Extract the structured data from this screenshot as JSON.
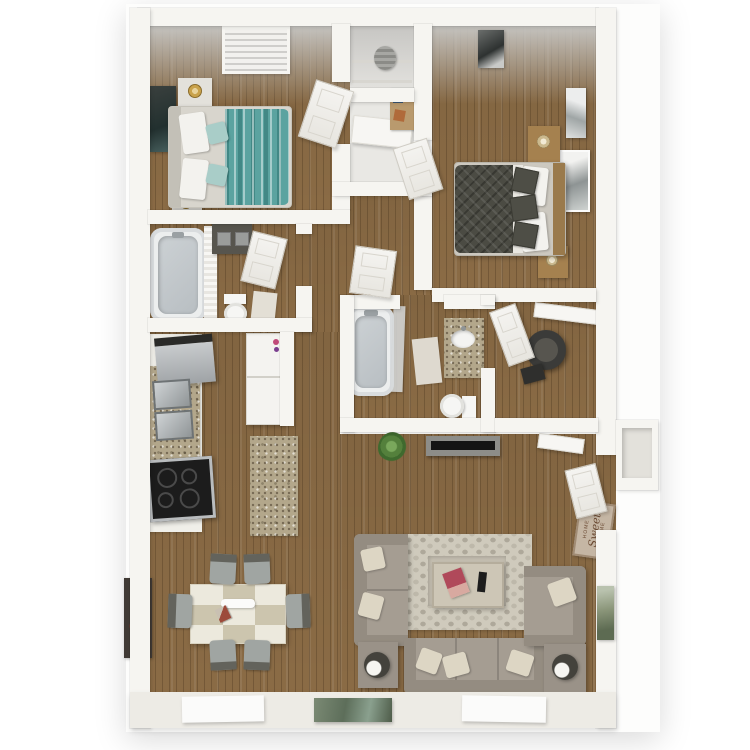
{
  "scene": {
    "kind": "3d-floor-plan-top-view",
    "unit": "2 bedroom / 2 bath apartment",
    "rooms": [
      {
        "name": "bedroom-1",
        "furniture": [
          "teal-striped-bed",
          "nightstand-x2",
          "gold-table-lamp-x2",
          "wall-art-dark",
          "ceiling-vent"
        ]
      },
      {
        "name": "hall-closets",
        "furniture": [
          "upper-closet-with-basket",
          "lower-closet-shelf"
        ]
      },
      {
        "name": "bedroom-2",
        "furniture": [
          "charcoal-quilted-bed",
          "nightstand-x2",
          "table-lamp-x2",
          "desk-with-accessories",
          "wall-art-x3"
        ]
      },
      {
        "name": "bathroom-1",
        "furniture": [
          "bathtub",
          "shower-curtain",
          "dark-vanity-double-sink",
          "toilet",
          "bath-rug"
        ]
      },
      {
        "name": "kitchen",
        "furniture": [
          "refrigerator",
          "double-basin-sink",
          "range-cooktop",
          "granite-counter",
          "granite-island",
          "washer-dryer-stack"
        ]
      },
      {
        "name": "bathroom-2",
        "furniture": [
          "bathtub",
          "granite-vanity-oval-sink",
          "toilet",
          "bath-mat"
        ]
      },
      {
        "name": "walk-in-closet",
        "furniture": [
          "dark-barrel-chair",
          "ottoman",
          "closet-shelf"
        ]
      },
      {
        "name": "dining-area",
        "furniture": [
          "checkered-dining-table",
          "white-serving-tray",
          "dining-chair-x6",
          "wall-art-red-floral"
        ]
      },
      {
        "name": "living-room",
        "furniture": [
          "loveseat",
          "three-seat-sofa",
          "armchair",
          "coffee-table",
          "magazine",
          "remote-control",
          "hex-pattern-rug",
          "end-table-x2",
          "round-lamp-x2",
          "tv-console",
          "flat-tv",
          "potted-plant",
          "wall-art-green"
        ]
      },
      {
        "name": "entry",
        "furniture": [
          "front-door",
          "home-sweet-home-mat",
          "wall-shelf",
          "exterior-alcove"
        ]
      },
      {
        "name": "exterior",
        "furniture": [
          "white-step-mat-x2",
          "photo-doormat"
        ]
      }
    ]
  },
  "doormat": {
    "line1": "HOME",
    "line2": "Sweet",
    "line3": "HOME"
  },
  "palette": {
    "wood": "#8a6b45",
    "wall": "#f6f5f1",
    "apron": "#edebe5",
    "ceiling": "#c6c5c2",
    "closet_floor": "#e9e8e4",
    "teal": "#5ba3a0",
    "teal_light": "#a9cdc8",
    "charcoal": "#4b4b43",
    "sofa": "#a59d92",
    "sofa_dark": "#948c81",
    "cushion": "#ddd6c4",
    "rug": "#cfcabc",
    "granite": "#b3a78b",
    "steel": "#b9bcbe",
    "range_black": "#1c1c1c",
    "chair_gray": "#a0a5a2",
    "chair_dark": "#63635c",
    "mat_tan": "#c5b6a4",
    "mat_text": "#6b4a33",
    "plant": "#54803c",
    "art_dark": "#3a403e",
    "art_red": "#97382a",
    "art_green": "#8a9579",
    "gold": "#c9a24b",
    "tub": "#eceeee",
    "basin": "#b8bec2"
  }
}
